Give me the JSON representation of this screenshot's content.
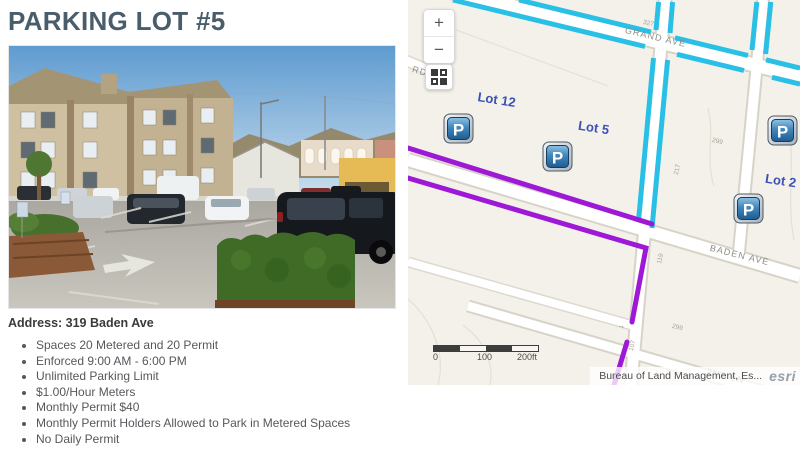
{
  "title": "PARKING LOT #5",
  "info": {
    "address": "Address: 319 Baden Ave",
    "bullets": [
      "Spaces 20 Metered and 20 Permit",
      "Enforced 9:00 AM - 6:00 PM",
      "Unlimited Parking Limit",
      "$1.00/Hour Meters",
      "Monthly Permit $40",
      "Monthly Permit Holders Allowed to Park in Metered Spaces",
      "No Daily Permit"
    ]
  },
  "map": {
    "controls": {
      "zoom_in": "+",
      "zoom_out": "−"
    },
    "lots": {
      "lot12": "Lot 12",
      "lot5": "Lot 5",
      "lot2": "Lot 2"
    },
    "streets": {
      "grand": "GRAND AVE",
      "baden": "BADEN AVE",
      "second_ln": "2ND LN",
      "rd": "RD"
    },
    "numbers": {
      "n327": "327",
      "n299": "299",
      "n217": "217",
      "n119": "119",
      "n299b": "299",
      "n107": "107",
      "arrow": "→"
    },
    "marker_letter": "P",
    "scalebar": {
      "start": "0",
      "mid": "100",
      "end": "200ft"
    },
    "attribution": "Bureau of Land Management, Es...",
    "esri_logo": "esri",
    "colors": {
      "metered_line": "#2AC0E6",
      "permit_line": "#9E19D6",
      "lot_label": "#3B51B5"
    }
  }
}
